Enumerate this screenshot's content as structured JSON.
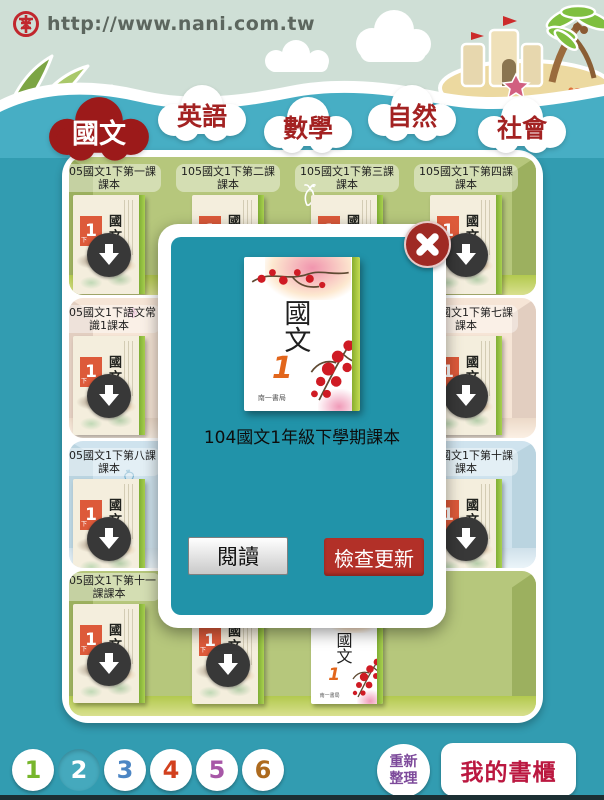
{
  "header": {
    "url": "http://www.nani.com.tw",
    "logo_icon": "nani-emblem-icon"
  },
  "tabs": [
    {
      "label": "國文",
      "active": true
    },
    {
      "label": "英語",
      "active": false
    },
    {
      "label": "數學",
      "active": false
    },
    {
      "label": "自然",
      "active": false
    },
    {
      "label": "社會",
      "active": false
    }
  ],
  "shelf": {
    "rows": [
      {
        "theme": "green",
        "pattern": "carrot-doodle",
        "slots": [
          {
            "label_line1": "105國文1下第一課",
            "label_line2": "課本",
            "cover": "ink",
            "download": true
          },
          {
            "label_line1": "105國文1下第二課",
            "label_line2": "課本",
            "cover": "ink",
            "download": true
          },
          {
            "label_line1": "105國文1下第三課",
            "label_line2": "課本",
            "cover": "ink",
            "download": true
          },
          {
            "label_line1": "105國文1下第四課",
            "label_line2": "課本",
            "cover": "ink",
            "download": true
          }
        ]
      },
      {
        "theme": "pink",
        "pattern": "flower-doodle",
        "slots": [
          {
            "label_line1": "105國文1下語文常",
            "label_line2": "識1課本",
            "cover": "ink",
            "download": true
          },
          {
            "label_line1": "105國文1下第七課",
            "label_line2": "課本",
            "cover": "ink",
            "download": true
          }
        ]
      },
      {
        "theme": "blue",
        "pattern": "strawberry-doodle",
        "slots": [
          {
            "label_line1": "105國文1下第八課",
            "label_line2": "課本",
            "cover": "ink",
            "download": true
          },
          {
            "label_line1": "105國文1下第十課",
            "label_line2": "課本",
            "cover": "ink",
            "download": true
          }
        ]
      },
      {
        "theme": "green",
        "pattern": "carrot-doodle",
        "slots": [
          {
            "label_line1": "105國文1下第十一",
            "label_line2": "課課本",
            "cover": "ink",
            "download": true
          },
          {
            "label_line1": "",
            "label_line2": "",
            "cover": "ink",
            "download": true
          },
          {
            "label_line1": "",
            "label_line2": "",
            "cover": "plum",
            "download": false
          }
        ]
      }
    ]
  },
  "book_cover": {
    "subject": "國文",
    "grade_number": "1",
    "semester": "下",
    "publisher": "南一書局"
  },
  "modal": {
    "title": "104國文1年級下學期課本",
    "read_button": "閱讀",
    "update_button": "檢查更新",
    "close_icon": "x-icon"
  },
  "pager": {
    "pages": [
      {
        "label": "1",
        "color": "#77b62c",
        "active": false
      },
      {
        "label": "2",
        "color": "#ffffff",
        "active": true
      },
      {
        "label": "3",
        "color": "#4c86c4",
        "active": false
      },
      {
        "label": "4",
        "color": "#d2401e",
        "active": false
      },
      {
        "label": "5",
        "color": "#a757a7",
        "active": false
      },
      {
        "label": "6",
        "color": "#ad6a1e",
        "active": false
      }
    ],
    "active_bg": "#45a9bd"
  },
  "footer": {
    "refresh_line1": "重新",
    "refresh_line2": "整理",
    "my_shelf": "我的書櫃"
  },
  "colors": {
    "main_teal": "#329cb1",
    "wave_blue": "#47aec4",
    "sky": "#cfdfd6",
    "active_tab_red": "#9c1a1a",
    "modal_panel": "#2193a9",
    "update_red": "#b23028",
    "download_badge": "#383838"
  }
}
